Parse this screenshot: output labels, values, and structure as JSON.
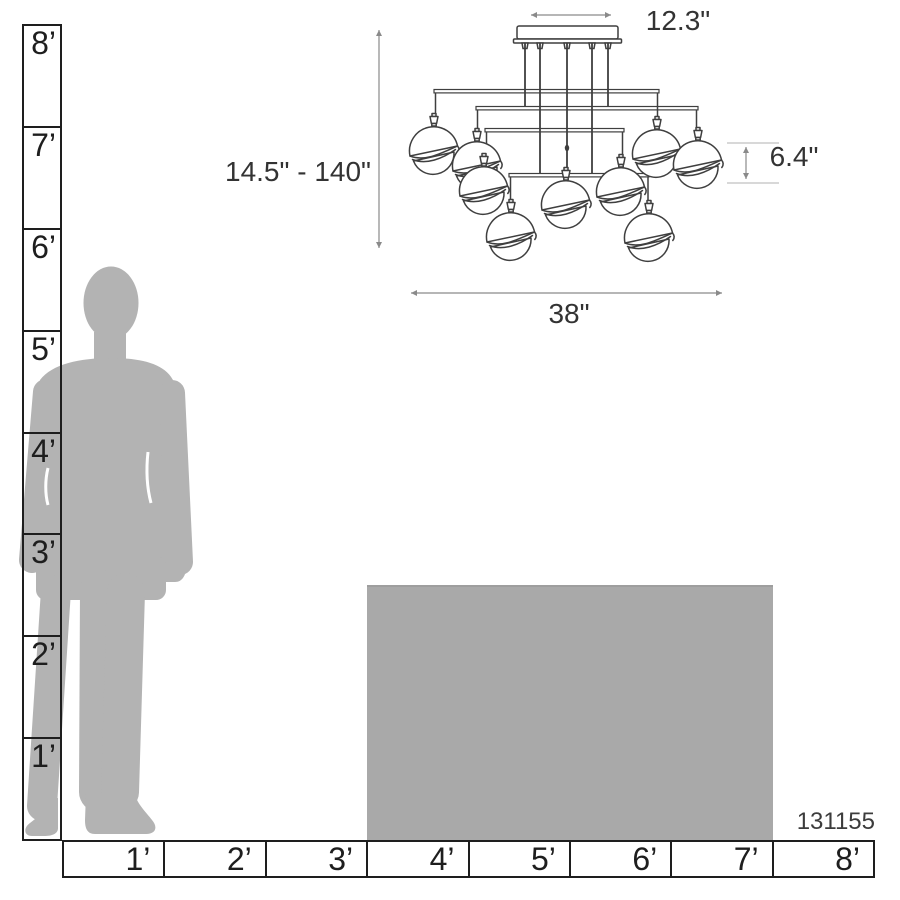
{
  "product": {
    "item_number": "131155"
  },
  "fixture": {
    "description": "multi-pendant double-shade chandelier line drawing",
    "pendant_count_visible": 9,
    "dimensions": {
      "canopy_width": "12.3\"",
      "height_range": "14.5\" - 140\"",
      "shade_height": "6.4\"",
      "overall_width": "38\""
    }
  },
  "rulers": {
    "vertical": {
      "unit": "feet",
      "labels": [
        "8’",
        "7’",
        "6’",
        "5’",
        "4’",
        "3’",
        "2’",
        "1’"
      ]
    },
    "horizontal": {
      "unit": "feet",
      "labels": [
        "1’",
        "2’",
        "3’",
        "4’",
        "5’",
        "6’",
        "7’",
        "8’"
      ]
    }
  },
  "reference_objects": {
    "person": "standing male silhouette (~5.6 ft tall)",
    "table": "gray block from 3 ft to 7 ft wide, ~2.5 ft tall"
  },
  "colors": {
    "silhouette": "#b3b3b3",
    "table": "#a9a9a9",
    "line_art": "#3f3f3f",
    "dimension_lines": "#8a8a8a",
    "extension_lines": "#cbcbcb",
    "text": "#333333",
    "ruler_text": "#1e1e1e"
  }
}
